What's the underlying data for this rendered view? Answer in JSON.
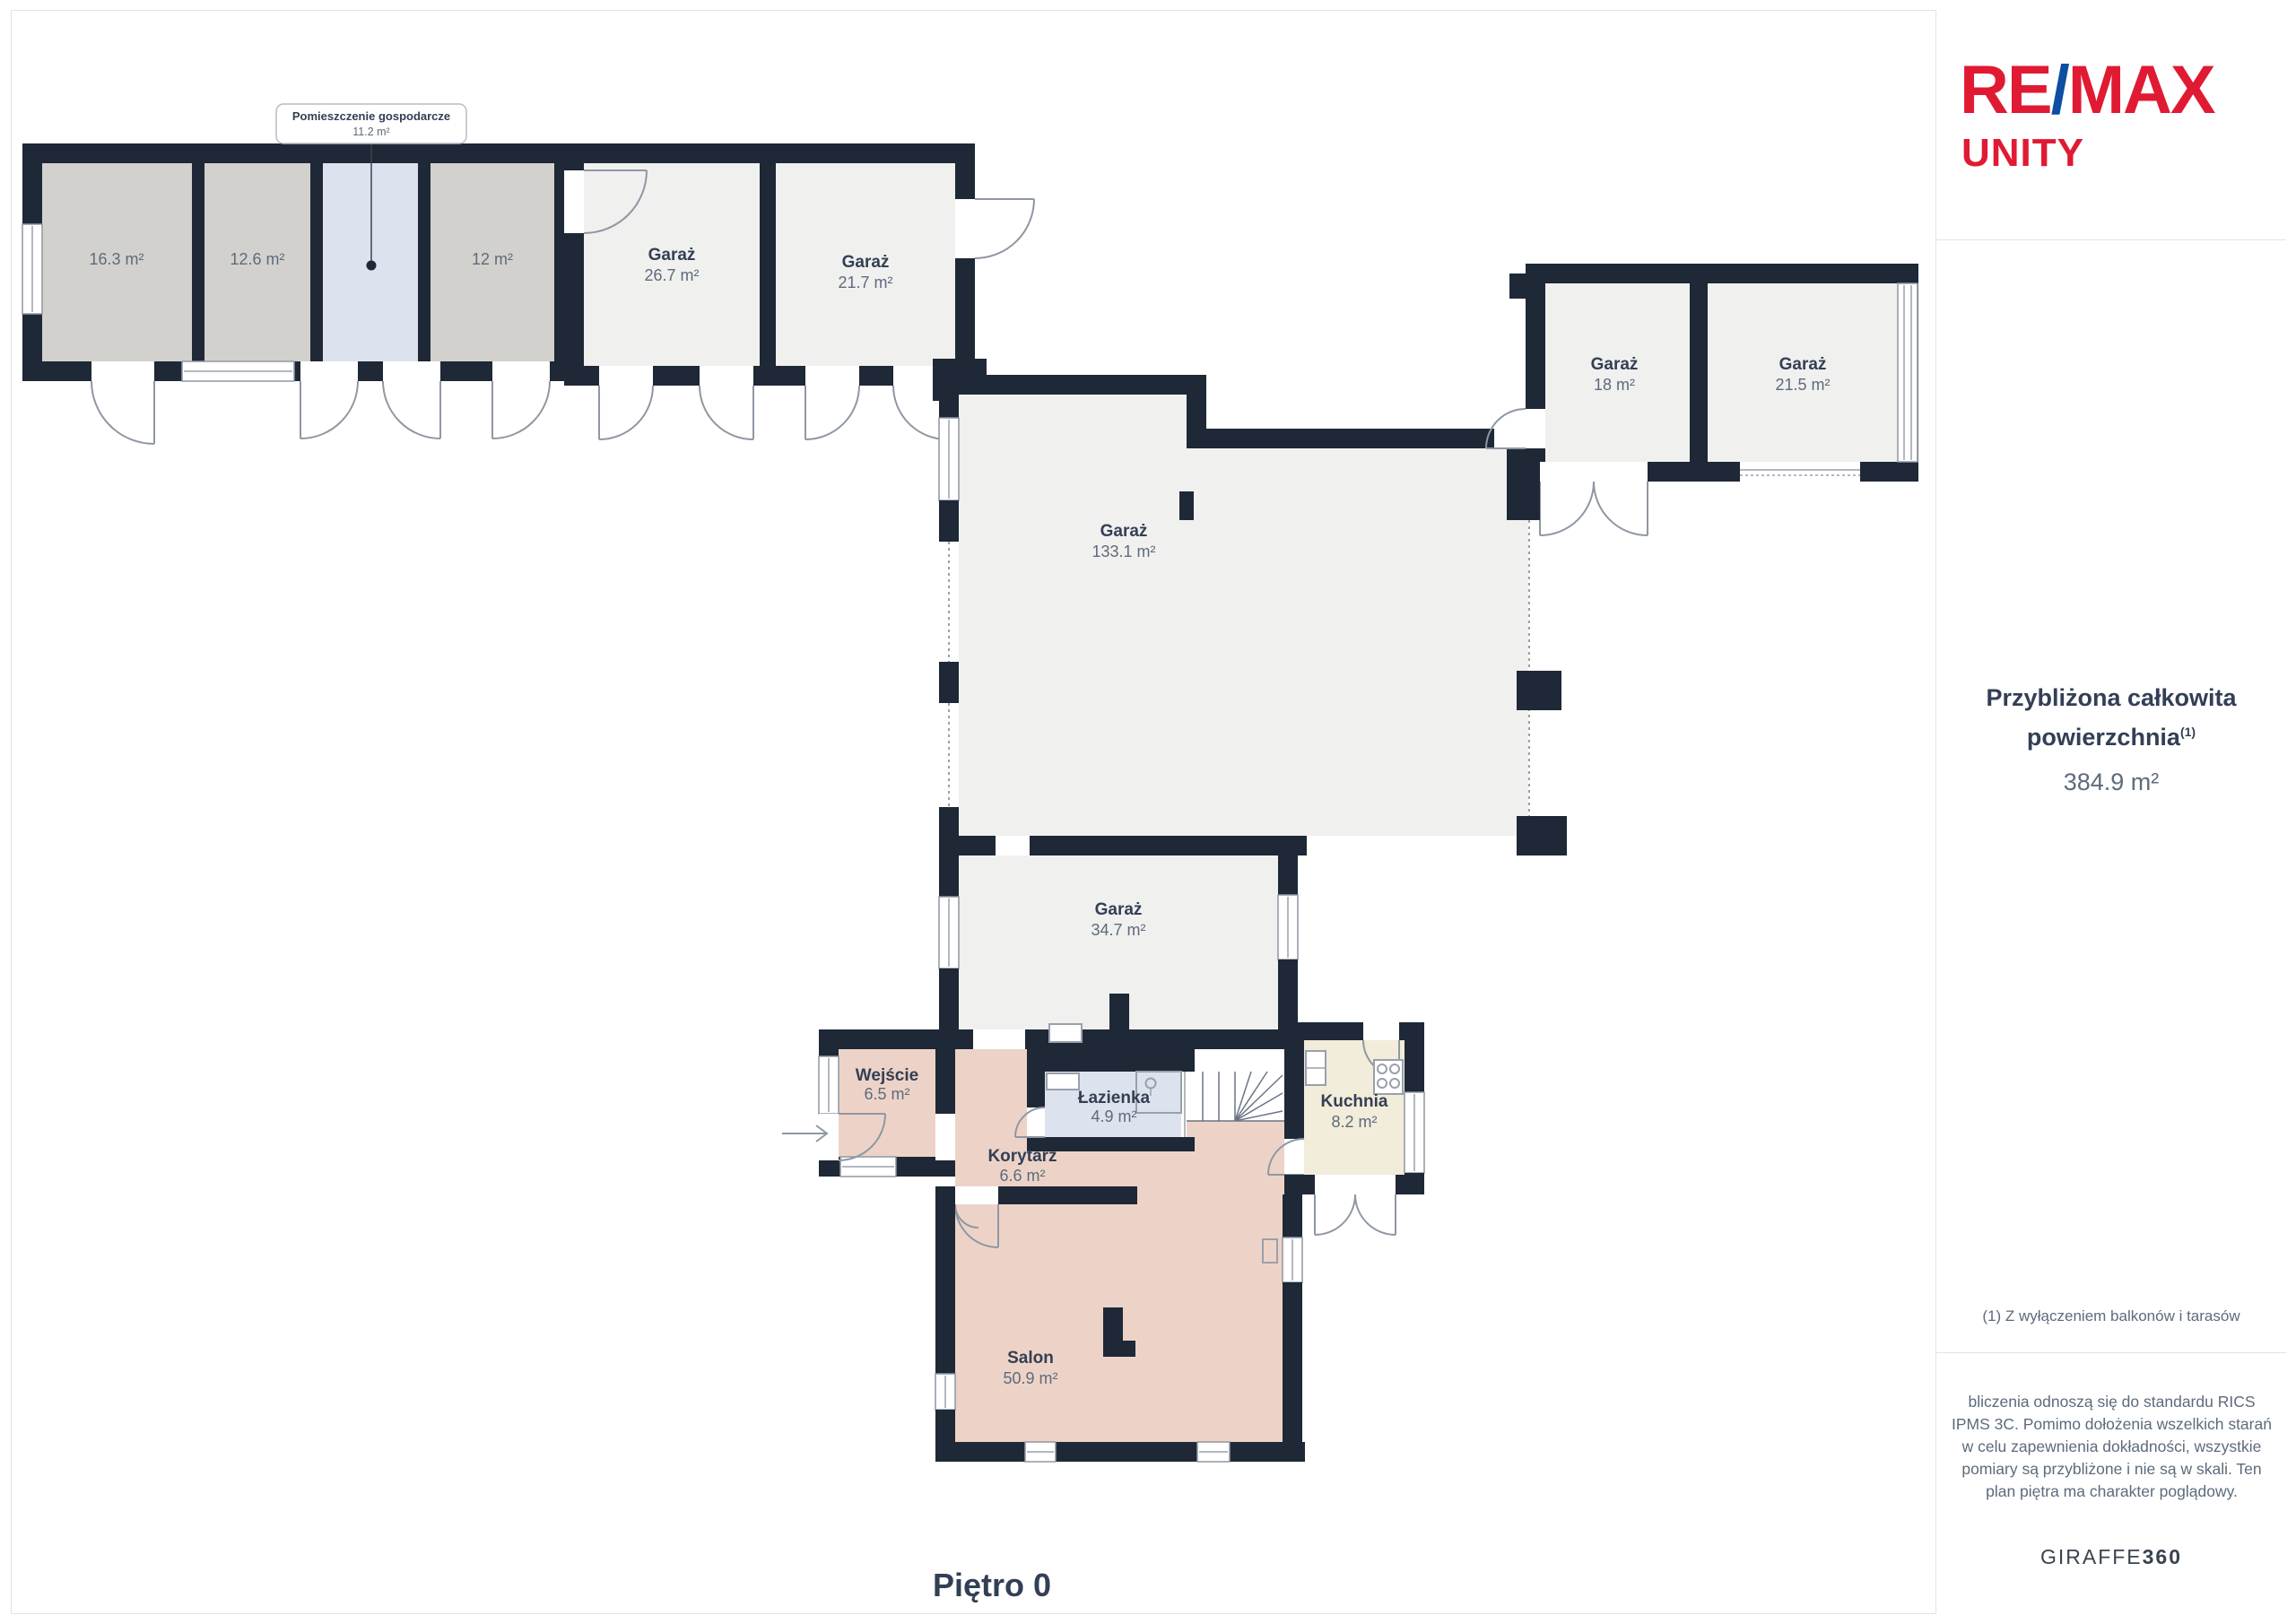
{
  "sidebar": {
    "logo": {
      "re": "RE",
      "slash": "/",
      "max": "MAX",
      "unity": "UNITY"
    },
    "total": {
      "title_line1": "Przybliżona całkowita",
      "title_line2": "powierzchnia",
      "sup": "(1)",
      "value": "384.9 m²"
    },
    "footnote": "(1) Z wyłączeniem balkonów i tarasów",
    "disclaimer": "bliczenia odnoszą się do standardu RICS IPMS 3C. Pomimo dołożenia wszelkich starań w celu zapewnienia dokładności, wszystkie pomiary są przybliżone i nie są w skali. Ten plan piętra ma charakter poglądowy.",
    "brand": {
      "giraffe": "GIRAFFE",
      "num": "360"
    }
  },
  "floor_label": "Piętro 0",
  "callout": {
    "name": "Pomieszczenie gospodarcze",
    "area": "11.2 m²"
  },
  "rooms": {
    "r163": {
      "area": "16.3 m²"
    },
    "r126": {
      "area": "12.6 m²"
    },
    "r12": {
      "area": "12 m²"
    },
    "garaz267": {
      "name": "Garaż",
      "area": "26.7 m²"
    },
    "garaz217": {
      "name": "Garaż",
      "area": "21.7 m²"
    },
    "garaz18": {
      "name": "Garaż",
      "area": "18 m²"
    },
    "garaz215": {
      "name": "Garaż",
      "area": "21.5 m²"
    },
    "garaz1331": {
      "name": "Garaż",
      "area": "133.1 m²"
    },
    "garaz347": {
      "name": "Garaż",
      "area": "34.7 m²"
    },
    "wejscie": {
      "name": "Wejście",
      "area": "6.5 m²"
    },
    "lazienka": {
      "name": "Łazienka",
      "area": "4.9 m²"
    },
    "kuchnia": {
      "name": "Kuchnia",
      "area": "8.2 m²"
    },
    "korytarz": {
      "name": "Korytarz",
      "area": "6.6 m²"
    },
    "salon": {
      "name": "Salon",
      "area": "50.9 m²"
    }
  },
  "colors": {
    "wall": "#1e2836",
    "garage_fill": "#f0f0ef",
    "storage_fill": "#d3d1cd",
    "blue_fill": "#dde3ee",
    "pink_fill": "#edd3c7",
    "cream_fill": "#f2ecda",
    "brand_red": "#e01a33",
    "brand_blue": "#0b4ea2"
  }
}
